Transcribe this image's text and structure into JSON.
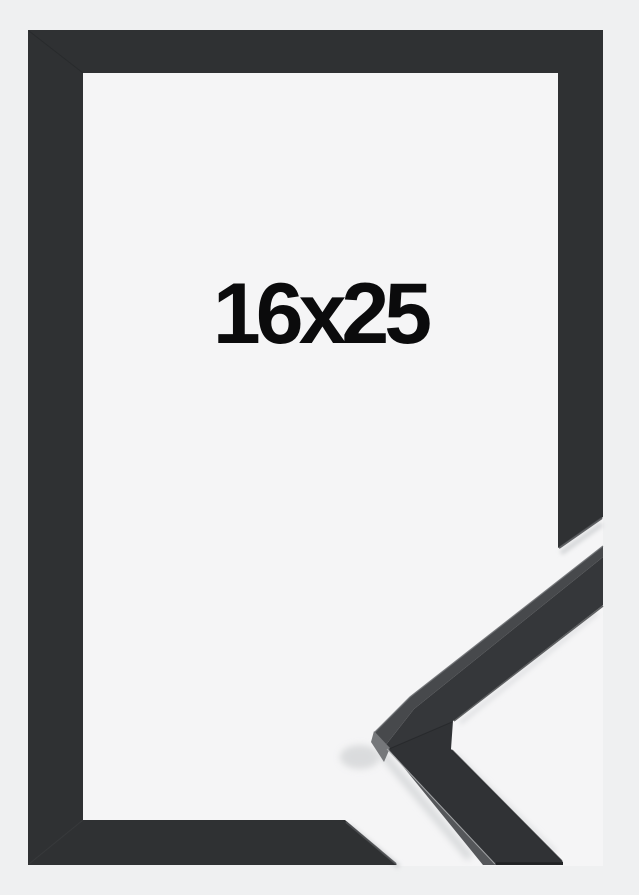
{
  "product": {
    "size_label": "16x25"
  },
  "colors": {
    "background": "#eff0f1",
    "paper": "#f5f5f6",
    "frame": "#2f3133",
    "sample_front": "#35373a",
    "sample_top_face": "#47494c",
    "sample_side_face": "#55575a",
    "sample_end_face": "#75777a",
    "label_text": "#0b0b0c"
  }
}
